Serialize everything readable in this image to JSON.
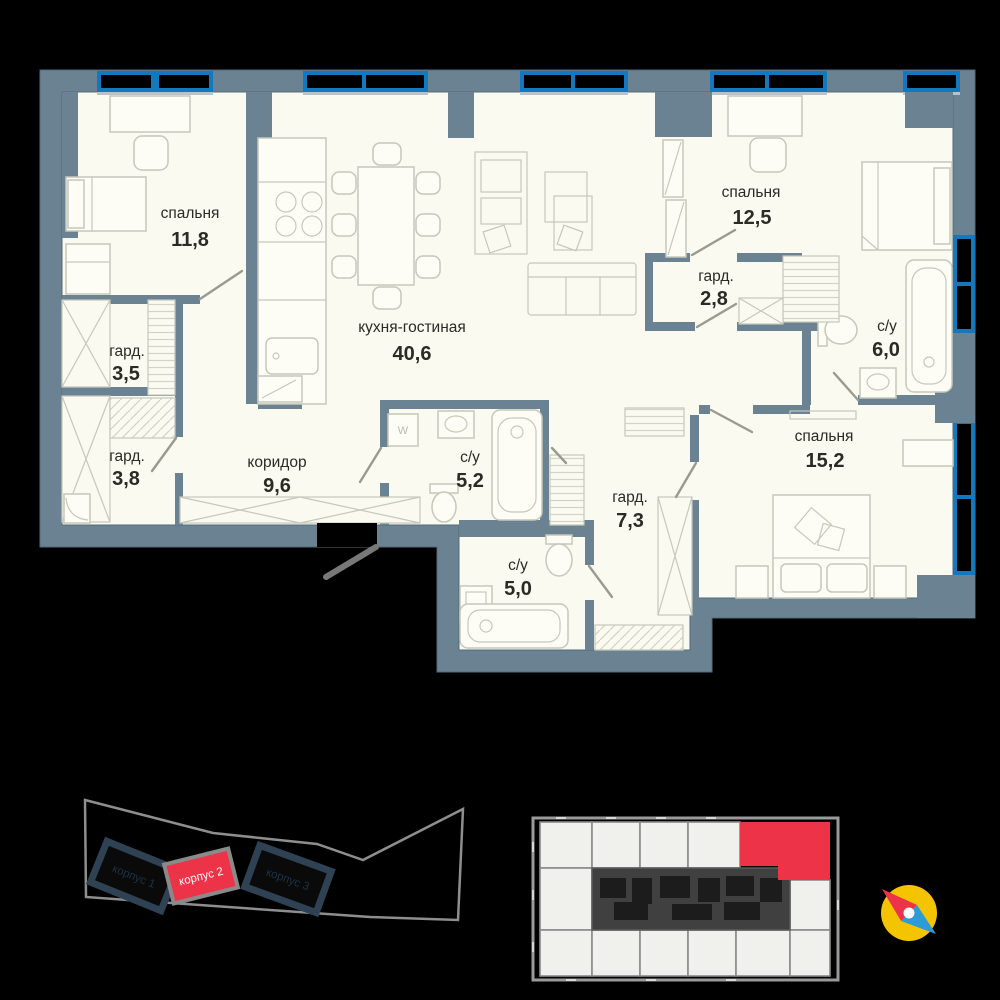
{
  "plan": {
    "title": "apartment-floor-plan",
    "rooms": [
      {
        "name": "спальня",
        "area": "11,8"
      },
      {
        "name": "кухня-гостиная",
        "area": "40,6"
      },
      {
        "name": "спальня",
        "area": "12,5"
      },
      {
        "name": "гард.",
        "area": "2,8"
      },
      {
        "name": "с/у",
        "area": "6,0"
      },
      {
        "name": "спальня",
        "area": "15,2"
      },
      {
        "name": "гард.",
        "area": "3,5"
      },
      {
        "name": "гард.",
        "area": "3,8"
      },
      {
        "name": "коридор",
        "area": "9,6"
      },
      {
        "name": "с/у",
        "area": "5,2"
      },
      {
        "name": "гард.",
        "area": "7,3"
      },
      {
        "name": "с/у",
        "area": "5,0"
      }
    ],
    "washer_label": "W"
  },
  "site": {
    "buildings": [
      {
        "label": "корпус 1",
        "highlighted": false
      },
      {
        "label": "корпус 2",
        "highlighted": true
      },
      {
        "label": "корпус 3",
        "highlighted": false
      }
    ]
  },
  "key_plan": {
    "highlighted_unit": "selected-apartment"
  },
  "colors": {
    "red": "#ED3347",
    "wall": "#6B8292",
    "floor": "#FAFAF0",
    "window_blue": "#1478BF",
    "compass_yellow": "#F5C400",
    "compass_blue": "#2E9BD6"
  }
}
